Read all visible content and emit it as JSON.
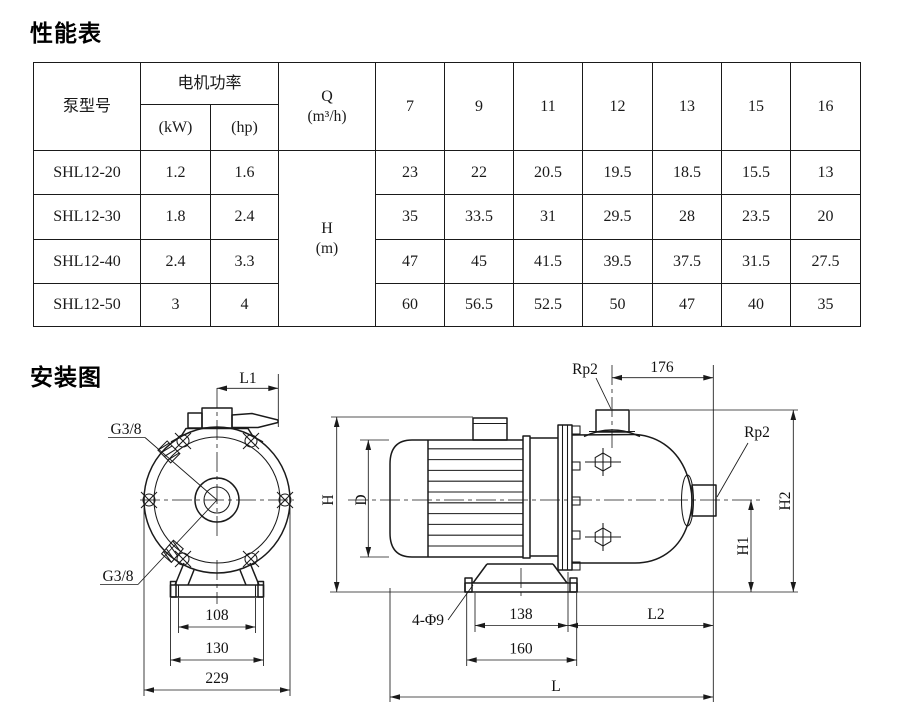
{
  "performance_section": {
    "title": "性能表",
    "table": {
      "header": {
        "pump_model": "泵型号",
        "motor_power": "电机功率",
        "kw": "(kW)",
        "hp": "(hp)",
        "q_label": "Q",
        "q_unit": "(m³/h)",
        "flow_values": [
          "7",
          "9",
          "11",
          "12",
          "13",
          "15",
          "16"
        ],
        "h_label": "H",
        "h_unit": "(m)"
      },
      "rows": [
        {
          "model": "SHL12-20",
          "kw": "1.2",
          "hp": "1.6",
          "heads": [
            "23",
            "22",
            "20.5",
            "19.5",
            "18.5",
            "15.5",
            "13"
          ]
        },
        {
          "model": "SHL12-30",
          "kw": "1.8",
          "hp": "2.4",
          "heads": [
            "35",
            "33.5",
            "31",
            "29.5",
            "28",
            "23.5",
            "20"
          ]
        },
        {
          "model": "SHL12-40",
          "kw": "2.4",
          "hp": "3.3",
          "heads": [
            "47",
            "45",
            "41.5",
            "39.5",
            "37.5",
            "31.5",
            "27.5"
          ]
        },
        {
          "model": "SHL12-50",
          "kw": "3",
          "hp": "4",
          "heads": [
            "60",
            "56.5",
            "52.5",
            "50",
            "47",
            "40",
            "35"
          ]
        }
      ]
    }
  },
  "installation_section": {
    "title": "安装图",
    "front_view": {
      "dim_l1": "L1",
      "thread_top": "G3/8",
      "thread_bottom": "G3/8",
      "dim_bolt_spacing": "108",
      "dim_base_width": "130",
      "dim_overall_width": "229"
    },
    "side_view": {
      "port_top_label": "Rp2",
      "port_side_label": "Rp2",
      "dim_port_offset": "176",
      "dim_height": "H",
      "dim_motor_diameter": "D",
      "dim_outlet_height": "H2",
      "dim_inlet_height": "H1",
      "dim_foot_holes": "4-Φ9",
      "dim_foot_spacing": "138",
      "dim_foot_length": "160",
      "dim_l2": "L2",
      "dim_overall_length": "L"
    }
  }
}
